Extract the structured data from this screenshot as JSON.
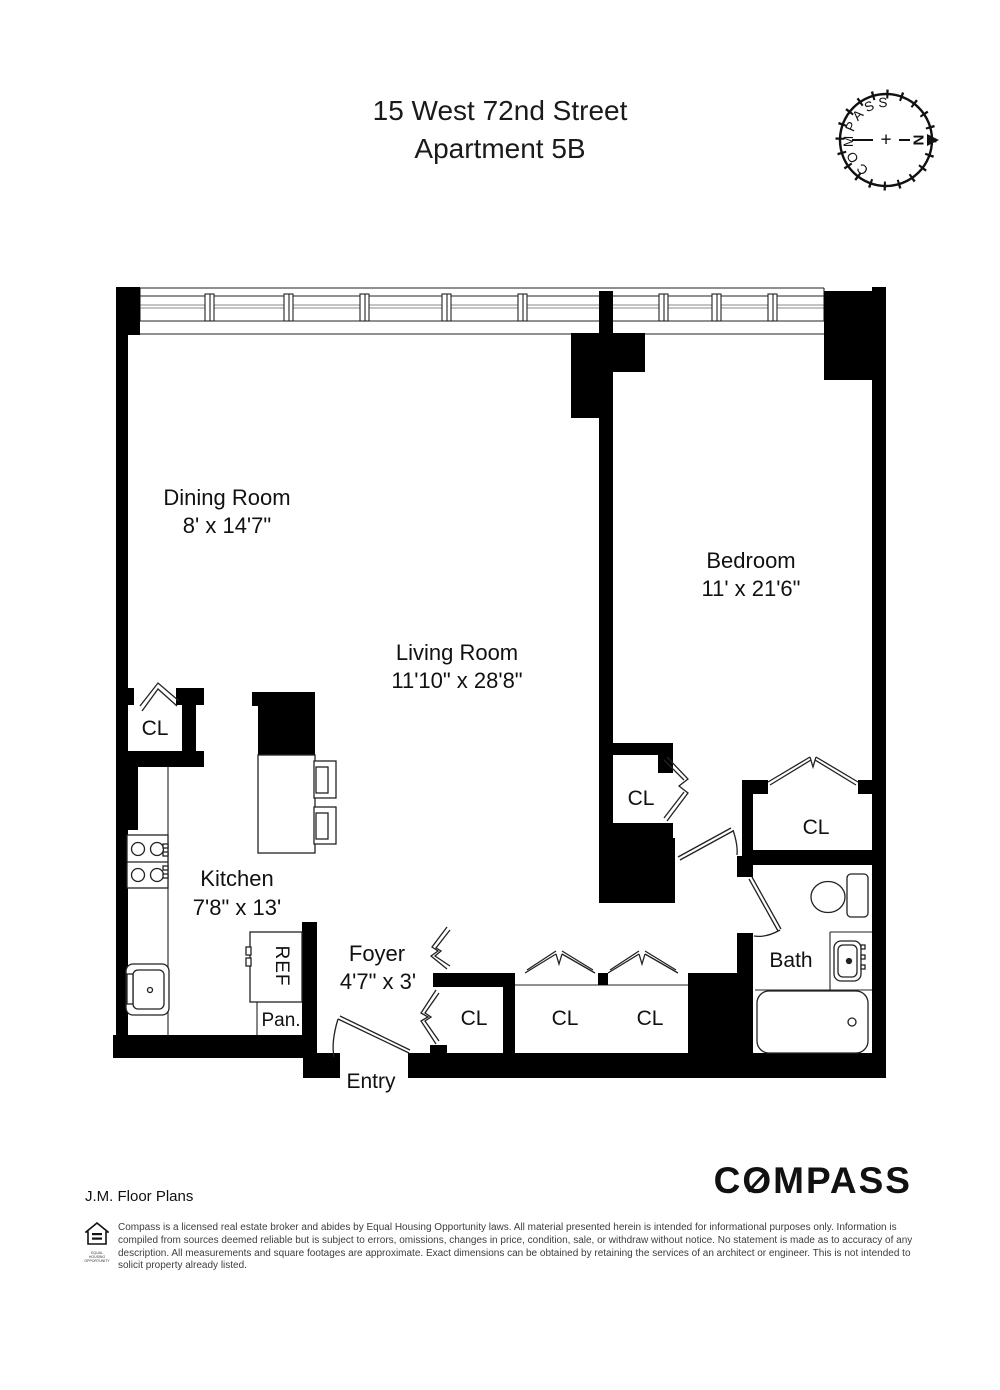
{
  "title": {
    "line1": "15 West 72nd Street",
    "line2": "Apartment 5B"
  },
  "compass_rose": {
    "brand": "COMPASS",
    "north": "N",
    "plus": "+"
  },
  "rooms": {
    "dining": {
      "name": "Dining Room",
      "dims": "8' x 14'7\""
    },
    "living": {
      "name": "Living Room",
      "dims": "11'10\" x 28'8\""
    },
    "bedroom": {
      "name": "Bedroom",
      "dims": "11' x 21'6\""
    },
    "kitchen": {
      "name": "Kitchen",
      "dims": "7'8\" x 13'"
    },
    "foyer": {
      "name": "Foyer",
      "dims": "4'7\" x 3'"
    },
    "bath": {
      "name": "Bath"
    },
    "entry": {
      "name": "Entry"
    }
  },
  "labels": {
    "closet": "CL",
    "refrigerator": "REF",
    "pantry": "Pan."
  },
  "footer": {
    "credit": "J.M. Floor Plans",
    "brand": "COMPASS",
    "brand_parts": {
      "c": "C",
      "o": "O",
      "rest": "MPASS"
    },
    "equal_housing": "EQUAL HOUSING OPPORTUNITY",
    "disclaimer": "Compass is a licensed real estate broker and abides by Equal Housing Opportunity laws. All material presented herein is intended for informational purposes only. Information is compiled from sources deemed reliable but is subject to errors, omissions, changes in price, condition, sale, or withdraw without notice. No statement is made as to accuracy of any description. All measurements and square footages are approximate. Exact dimensions can be obtained by retaining the services of an architect or engineer. This is not intended to solicit property already listed."
  },
  "colors": {
    "wall": "#000000",
    "north_accent": "#c62828",
    "text": "#1a1a1a",
    "disclaimer_text": "#3d3d3d"
  }
}
